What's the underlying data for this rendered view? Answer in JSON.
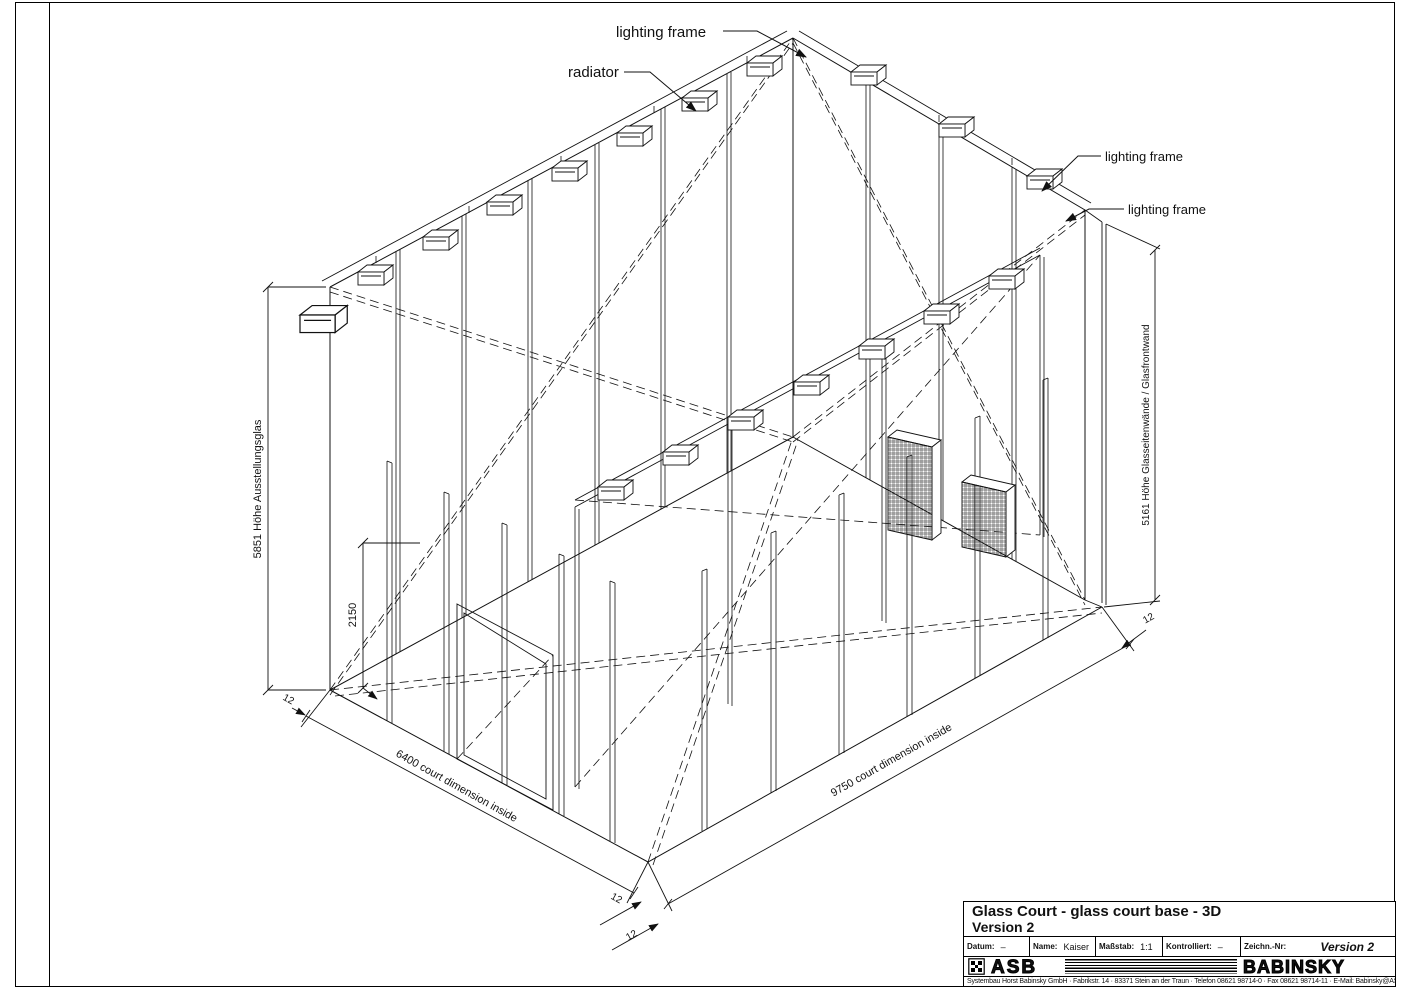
{
  "drawing": {
    "callouts": {
      "lighting_frame_top": "lighting frame",
      "radiator": "radiator",
      "lighting_frame_mid": "lighting frame",
      "lighting_frame_low": "lighting frame"
    },
    "dimensions": {
      "height_left": "5851  Höhe Ausstellungsglas",
      "height_inner": "2150",
      "height_right": "5161  Höhe Glasseitenwände / Glasfrontwand",
      "width_left": "6400  court dimension inside",
      "width_right": "9750  court dimension inside",
      "glass_thickness": "12"
    }
  },
  "title_block": {
    "title_line1": "Glass Court - glass court base - 3D",
    "title_line2": "Version 2",
    "fields": [
      {
        "label": "Datum:",
        "value": "–"
      },
      {
        "label": "Name:",
        "value": "Kaiser"
      },
      {
        "label": "Maßstab:",
        "value": "1:1"
      },
      {
        "label": "Kontrolliert:",
        "value": "–"
      },
      {
        "label": "Zeichn.-Nr:",
        "value": "Version 2"
      }
    ],
    "brand_left": "ASB",
    "brand_right": "BABINSKY",
    "footer": "Systembau Horst Babinsky GmbH · Fabrikstr. 14 · 83371 Stein an der Traun · Telefon 08621 98714-0 · Fax 08621 98714-11 · E-Mail: Babinsky@ASBsquash.com"
  }
}
